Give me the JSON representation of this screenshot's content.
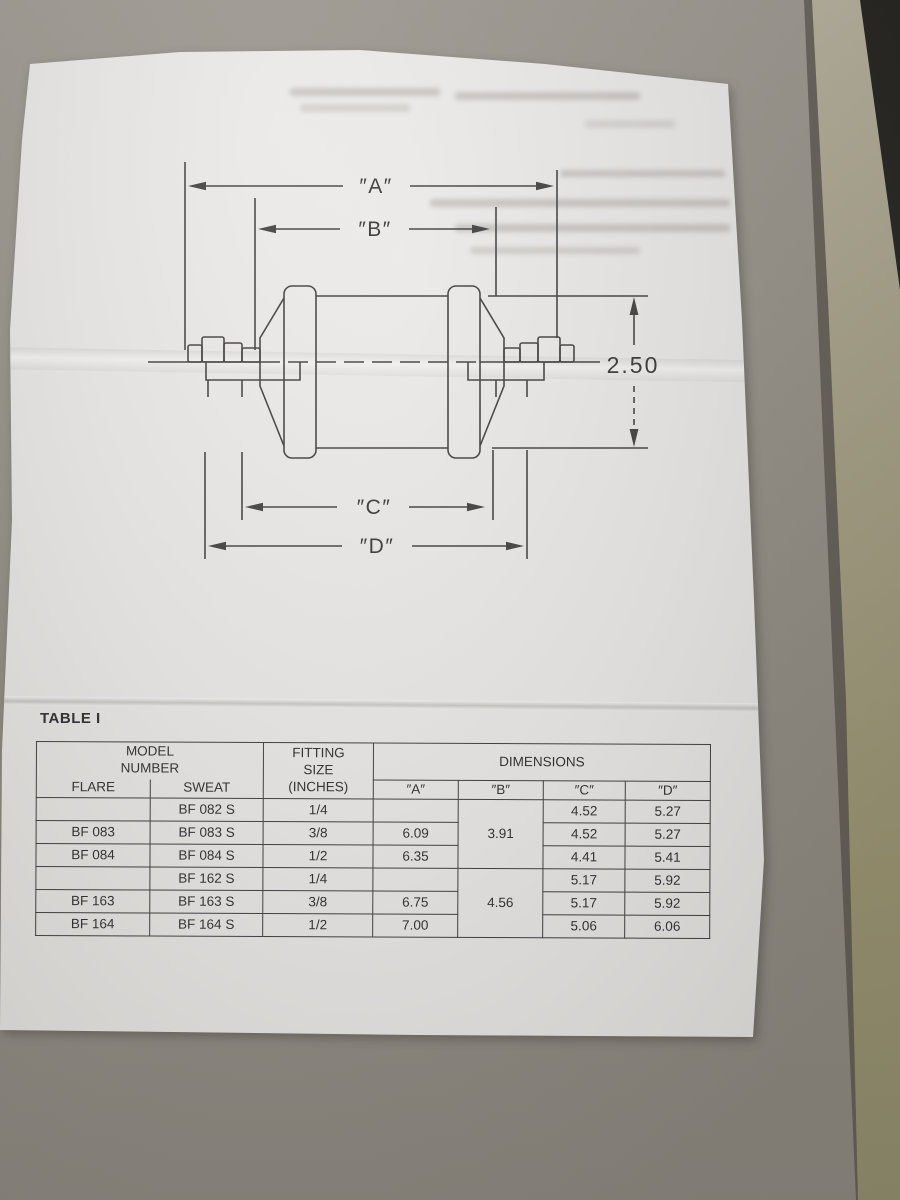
{
  "table_label": "TABLE I",
  "drawing": {
    "dim_a": "″A″",
    "dim_b": "″B″",
    "dim_c": "″C″",
    "dim_d": "″D″",
    "dim_height": "2.50"
  },
  "table": {
    "headers": {
      "model_number": "MODEL\nNUMBER",
      "flare": "FLARE",
      "sweat": "SWEAT",
      "fitting_size": "FITTING\nSIZE\n(INCHES)",
      "dimensions": "DIMENSIONS",
      "a": "″A″",
      "b": "″B″",
      "c": "″C″",
      "d": "″D″"
    },
    "rows": [
      {
        "cells": [
          {
            "v": ""
          },
          {
            "v": "BF 082 S"
          },
          {
            "v": "1/4"
          },
          {
            "v": ""
          },
          {
            "v": "3.91",
            "rowspan": 3
          },
          {
            "v": "4.52"
          },
          {
            "v": "5.27"
          }
        ]
      },
      {
        "cells": [
          {
            "v": "BF 083"
          },
          {
            "v": "BF 083 S"
          },
          {
            "v": "3/8"
          },
          {
            "v": "6.09"
          },
          {
            "v": "4.52"
          },
          {
            "v": "5.27"
          }
        ]
      },
      {
        "cells": [
          {
            "v": "BF 084"
          },
          {
            "v": "BF 084 S"
          },
          {
            "v": "1/2"
          },
          {
            "v": "6.35"
          },
          {
            "v": "4.41"
          },
          {
            "v": "5.41"
          }
        ]
      },
      {
        "cells": [
          {
            "v": ""
          },
          {
            "v": "BF 162 S"
          },
          {
            "v": "1/4"
          },
          {
            "v": ""
          },
          {
            "v": "4.56",
            "rowspan": 3
          },
          {
            "v": "5.17"
          },
          {
            "v": "5.92"
          }
        ]
      },
      {
        "cells": [
          {
            "v": "BF 163"
          },
          {
            "v": "BF 163 S"
          },
          {
            "v": "3/8"
          },
          {
            "v": "6.75"
          },
          {
            "v": "5.17"
          },
          {
            "v": "5.92"
          }
        ]
      },
      {
        "cells": [
          {
            "v": "BF 164"
          },
          {
            "v": "BF 164 S"
          },
          {
            "v": "1/2"
          },
          {
            "v": "7.00"
          },
          {
            "v": "5.06"
          },
          {
            "v": "6.06"
          }
        ]
      }
    ]
  }
}
